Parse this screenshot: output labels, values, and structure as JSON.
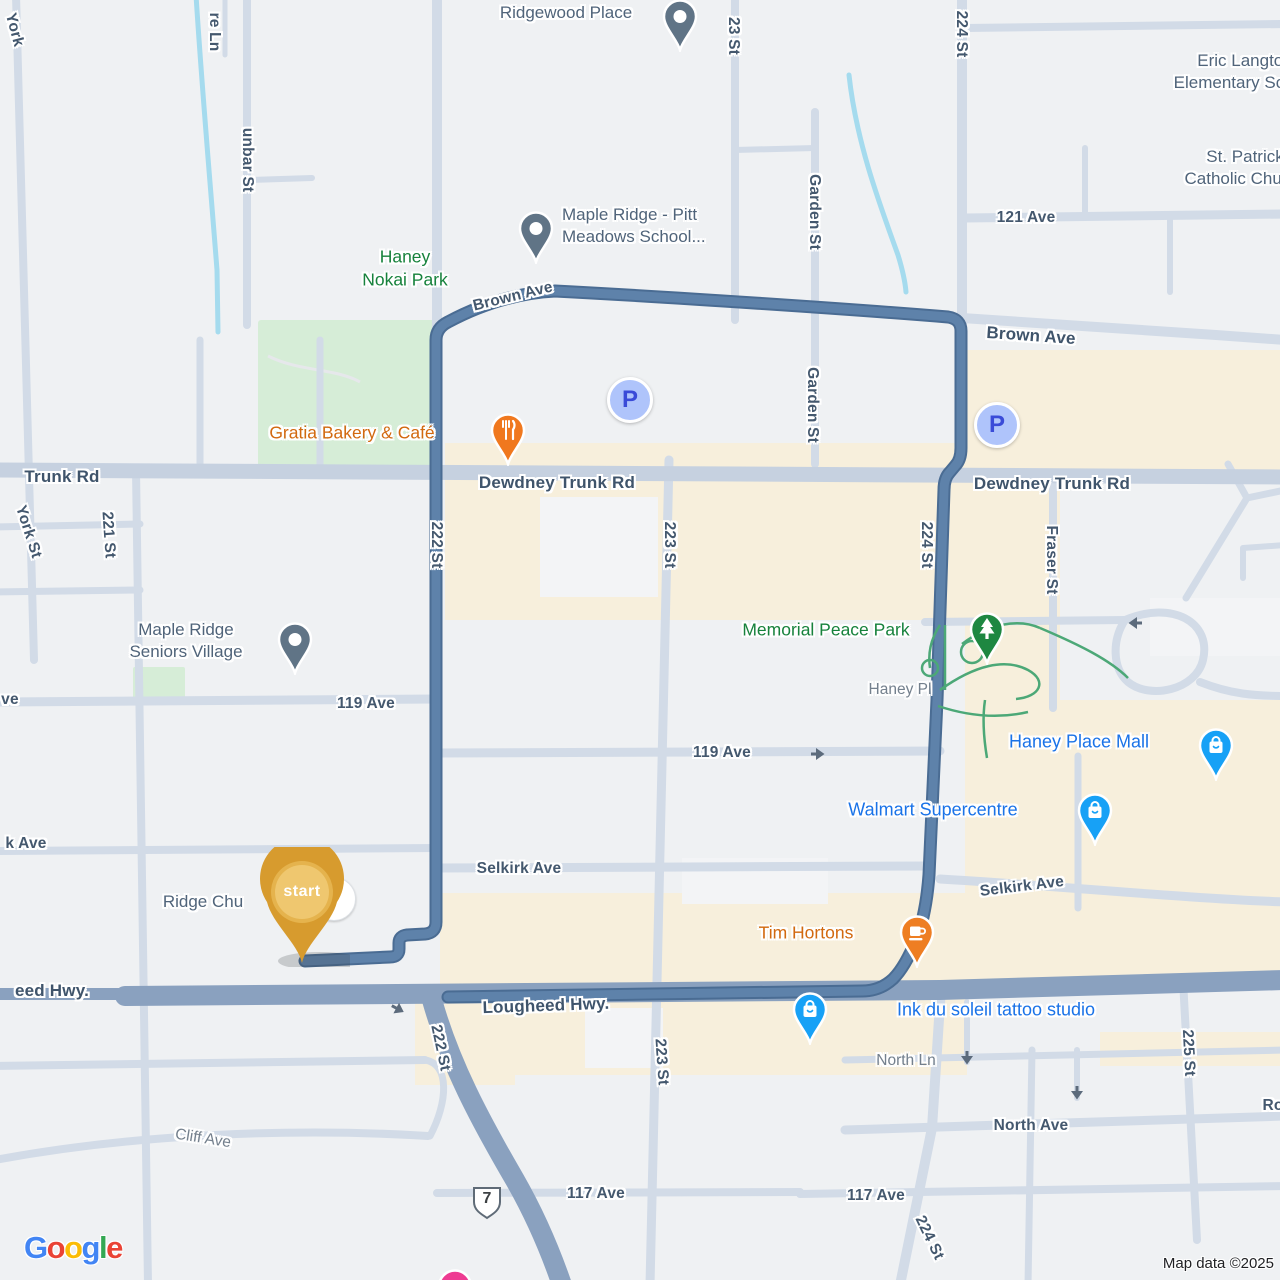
{
  "map": {
    "attribution": "Map data ©2025",
    "route_shield": "7",
    "parking_label": "P",
    "start_marker_label": "start",
    "colors": {
      "route": "#5E82AA",
      "route_casing": "#4A6C93",
      "highway": "#8AA1BF",
      "minor_road": "#D2DBE7",
      "commercial_area": "#F7EFDC",
      "park_green": "#D6EDD7",
      "water": "#A5DBEE",
      "poi_blue": "#1A73E8",
      "poi_orange": "#D2690F",
      "poi_green_text": "#17823C",
      "street_label": "#44586E",
      "start_pin_gold": "#D79B2E"
    },
    "logo_letters": [
      {
        "ch": "G",
        "color": "#4285F4"
      },
      {
        "ch": "o",
        "color": "#EA4335"
      },
      {
        "ch": "o",
        "color": "#FBBC05"
      },
      {
        "ch": "g",
        "color": "#4285F4"
      },
      {
        "ch": "l",
        "color": "#34A853"
      },
      {
        "ch": "e",
        "color": "#EA4335"
      }
    ],
    "labels": [
      {
        "t": "York",
        "x": 14,
        "y": 30,
        "r": 75,
        "c": "st",
        "n": "street-label-york"
      },
      {
        "t": "unbar St",
        "x": 247,
        "y": 160,
        "r": 90,
        "c": "st",
        "n": "street-label-dunbar-st"
      },
      {
        "t": "re Ln",
        "x": 214,
        "y": 32,
        "r": 90,
        "c": "st",
        "n": "street-label-re-ln"
      },
      {
        "t": "Ridgewood Place",
        "x": 566,
        "y": 13,
        "c": "poi",
        "n": "poi-label-ridgewood-place"
      },
      {
        "t": "23 St",
        "x": 733,
        "y": 36,
        "r": 90,
        "c": "st",
        "n": "street-label-223-st-top"
      },
      {
        "t": "224 St",
        "x": 961,
        "y": 34,
        "r": 90,
        "c": "st",
        "n": "street-label-224-st-top"
      },
      {
        "t": "Eric Langton\nElementary School",
        "x": 1115,
        "y": 50,
        "w": 260,
        "c": "poi",
        "n": "poi-label-eric-langton"
      },
      {
        "t": "St. Patrick\nCatholic Church",
        "x": 1125,
        "y": 146,
        "w": 240,
        "c": "poi",
        "n": "poi-label-st-patrick"
      },
      {
        "t": "121 Ave",
        "x": 1026,
        "y": 218,
        "c": "st",
        "n": "street-label-121-ave"
      },
      {
        "t": "Garden St",
        "x": 814,
        "y": 212,
        "r": 90,
        "c": "st",
        "n": "street-label-garden-st"
      },
      {
        "t": "Garden St",
        "x": 812,
        "y": 405,
        "r": 90,
        "c": "st",
        "n": "street-label-garden-st-2"
      },
      {
        "t": "Maple Ridge - Pitt\nMeadows School...",
        "x": 562,
        "y": 204,
        "a": "l",
        "c": "poi",
        "n": "poi-label-maple-ridge-school"
      },
      {
        "t": "Haney\nNokai Park",
        "x": 405,
        "y": 268,
        "c": "green",
        "n": "poi-label-haney-nokai-park"
      },
      {
        "t": "Brown Ave",
        "x": 513,
        "y": 297,
        "r": -14,
        "c": "st",
        "n": "street-label-brown-ave-west"
      },
      {
        "t": "Brown Ave",
        "x": 1031,
        "y": 336,
        "r": 4,
        "c": "st-lg",
        "n": "street-label-brown-ave-east"
      },
      {
        "t": "Gratia Bakery & Café",
        "x": 352,
        "y": 433,
        "c": "orange",
        "n": "poi-label-gratia-bakery"
      },
      {
        "t": "Trunk Rd",
        "x": 62,
        "y": 477,
        "c": "st-lg",
        "n": "street-label-trunk-rd-west"
      },
      {
        "t": "Dewdney Trunk Rd",
        "x": 557,
        "y": 483,
        "c": "st-lg",
        "n": "street-label-dewdney-trunk-rd"
      },
      {
        "t": "Dewdney Trunk Rd",
        "x": 1052,
        "y": 484,
        "c": "st-lg",
        "n": "street-label-dewdney-trunk-rd-2"
      },
      {
        "t": "222 St",
        "x": 436,
        "y": 545,
        "r": 90,
        "c": "st",
        "n": "street-label-222-st"
      },
      {
        "t": "223 St",
        "x": 669,
        "y": 545,
        "r": 90,
        "c": "st",
        "n": "street-label-223-st"
      },
      {
        "t": "224 St",
        "x": 926,
        "y": 545,
        "r": 90,
        "c": "st",
        "n": "street-label-224-st"
      },
      {
        "t": "York St",
        "x": 28,
        "y": 532,
        "r": 72,
        "c": "st",
        "n": "street-label-york-st"
      },
      {
        "t": "221 St",
        "x": 108,
        "y": 535,
        "r": 86,
        "c": "st",
        "n": "street-label-221-st"
      },
      {
        "t": "Fraser St",
        "x": 1051,
        "y": 560,
        "r": 90,
        "c": "st",
        "n": "street-label-fraser-st"
      },
      {
        "t": "Maple Ridge\nSeniors Village",
        "x": 186,
        "y": 641,
        "c": "poi",
        "n": "poi-label-seniors-village"
      },
      {
        "t": "Memorial Peace Park",
        "x": 826,
        "y": 630,
        "c": "green",
        "n": "poi-label-memorial-peace-park"
      },
      {
        "t": "Haney Pl",
        "x": 900,
        "y": 690,
        "c": "minor",
        "n": "street-label-haney-pl"
      },
      {
        "t": "ve",
        "x": 10,
        "y": 700,
        "c": "st",
        "n": "street-label-ave-partial"
      },
      {
        "t": "119 Ave",
        "x": 366,
        "y": 704,
        "c": "st",
        "n": "street-label-119-ave-west"
      },
      {
        "t": "119 Ave",
        "x": 722,
        "y": 753,
        "c": "st",
        "n": "street-label-119-ave-east"
      },
      {
        "t": "Haney Place Mall",
        "x": 1079,
        "y": 742,
        "c": "blue",
        "n": "poi-label-haney-place-mall"
      },
      {
        "t": "Walmart Supercentre",
        "x": 933,
        "y": 810,
        "c": "blue",
        "n": "poi-label-walmart"
      },
      {
        "t": "k Ave",
        "x": 26,
        "y": 844,
        "c": "st",
        "n": "street-label-k-ave-partial"
      },
      {
        "t": "Selkirk Ave",
        "x": 519,
        "y": 869,
        "c": "st",
        "n": "street-label-selkirk-ave"
      },
      {
        "t": "Selkirk Ave",
        "x": 1022,
        "y": 887,
        "r": -7,
        "c": "st",
        "n": "street-label-selkirk-ave-east"
      },
      {
        "t": "Ridge Chu",
        "x": 203,
        "y": 902,
        "c": "poi",
        "n": "poi-label-ridge-church"
      },
      {
        "t": "Tim Hortons",
        "x": 806,
        "y": 933,
        "c": "orange",
        "n": "poi-label-tim-hortons"
      },
      {
        "t": "eed Hwy.",
        "x": 52,
        "y": 991,
        "c": "st-lg",
        "n": "street-label-lougheed-hwy-partial"
      },
      {
        "t": "Lougheed Hwy.",
        "x": 546,
        "y": 1006,
        "r": -2,
        "c": "st-lg",
        "n": "street-label-lougheed-hwy"
      },
      {
        "t": "Ink du soleil tattoo studio",
        "x": 996,
        "y": 1010,
        "c": "blue",
        "n": "poi-label-ink-du-soleil"
      },
      {
        "t": "North Ln",
        "x": 906,
        "y": 1061,
        "c": "minor",
        "n": "street-label-north-ln"
      },
      {
        "t": "222 St",
        "x": 440,
        "y": 1048,
        "r": 78,
        "c": "st",
        "n": "street-label-222-st-south"
      },
      {
        "t": "North Ave",
        "x": 1031,
        "y": 1126,
        "c": "st",
        "n": "street-label-north-ave"
      },
      {
        "t": "117 Ave",
        "x": 596,
        "y": 1194,
        "c": "st",
        "n": "street-label-117-ave-west"
      },
      {
        "t": "117 Ave",
        "x": 876,
        "y": 1196,
        "c": "st",
        "n": "street-label-117-ave-east"
      },
      {
        "t": "223 St",
        "x": 661,
        "y": 1062,
        "r": 86,
        "c": "st",
        "n": "street-label-223-st-south"
      },
      {
        "t": "224 St",
        "x": 929,
        "y": 1238,
        "r": 64,
        "c": "st",
        "n": "street-label-224-st-south"
      },
      {
        "t": "225 St",
        "x": 1188,
        "y": 1053,
        "r": 87,
        "c": "st",
        "n": "street-label-225-st"
      },
      {
        "t": "Cliff Ave",
        "x": 203,
        "y": 1139,
        "r": 9,
        "c": "minor",
        "n": "street-label-cliff-ave"
      },
      {
        "t": "Ro",
        "x": 1273,
        "y": 1106,
        "c": "st",
        "n": "street-label-ro-partial"
      }
    ],
    "pins": [
      {
        "kind": "dot",
        "x": 680,
        "y": 50,
        "title": "Ridgewood Place"
      },
      {
        "kind": "dot",
        "x": 536,
        "y": 262,
        "title": "Maple Ridge - Pitt Meadows School"
      },
      {
        "kind": "dot",
        "x": 295,
        "y": 673,
        "title": "Maple Ridge Seniors Village"
      },
      {
        "kind": "tree",
        "x": 987,
        "y": 663,
        "title": "Memorial Peace Park"
      },
      {
        "kind": "bag",
        "x": 1216,
        "y": 779,
        "title": "Haney Place Mall"
      },
      {
        "kind": "bag",
        "x": 1095,
        "y": 844,
        "title": "Walmart Supercentre"
      },
      {
        "kind": "bag",
        "x": 810,
        "y": 1043,
        "title": "Ink du soleil tattoo studio"
      },
      {
        "kind": "cup",
        "x": 917,
        "y": 966,
        "title": "Tim Hortons"
      },
      {
        "kind": "rest",
        "x": 508,
        "y": 464,
        "title": "Gratia Bakery & Café"
      },
      {
        "kind": "pink",
        "x": 455,
        "y": 1320,
        "title": "poi-bottom"
      },
      {
        "kind": "church",
        "x": 333,
        "y": 898,
        "title": "Ridge Church"
      },
      {
        "kind": "start",
        "x": 302,
        "y": 963,
        "title": "start"
      }
    ],
    "parking_icons": [
      {
        "x": 630,
        "y": 400
      },
      {
        "x": 997,
        "y": 425
      }
    ],
    "one_way_arrows": [
      {
        "x": 818,
        "y": 754,
        "r": 0
      },
      {
        "x": 1135,
        "y": 623,
        "r": 180
      },
      {
        "x": 967,
        "y": 1058,
        "r": 90
      },
      {
        "x": 1077,
        "y": 1093,
        "r": 90
      },
      {
        "x": 398,
        "y": 1009,
        "r": 28
      }
    ]
  }
}
